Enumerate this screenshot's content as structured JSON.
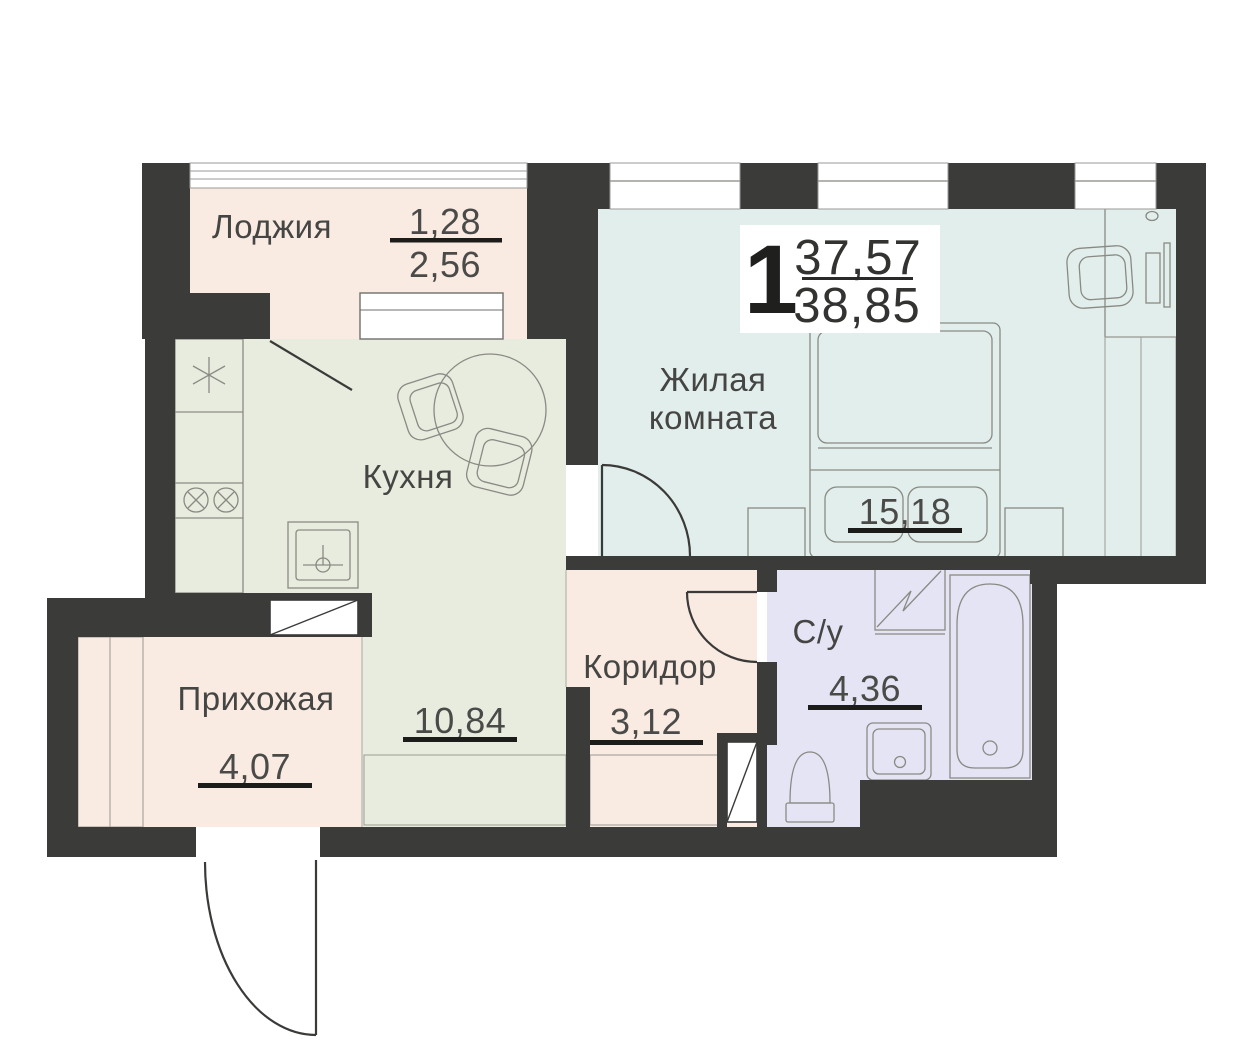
{
  "colors": {
    "wall": "#3b3b39",
    "loggia": "#f9eae2",
    "kitchen": "#e8ecdf",
    "living": "#e2eeec",
    "corridor": "#f9eae2",
    "hallway": "#f9eae2",
    "bathroom": "#e4e4f4"
  },
  "summary": {
    "rooms_count": "1",
    "living_area": "37,57",
    "total_area": "38,85"
  },
  "rooms": {
    "loggia": {
      "label": "Лоджия",
      "area_reduced": "1,28",
      "area_full": "2,56"
    },
    "kitchen": {
      "label": "Кухня",
      "area": "10,84"
    },
    "living": {
      "label_line1": "Жилая",
      "label_line2": "комната",
      "area": "15,18"
    },
    "corridor": {
      "label": "Коридор",
      "area": "3,12"
    },
    "hallway": {
      "label": "Прихожая",
      "area": "4,07"
    },
    "bathroom": {
      "label": "С/у",
      "area": "4,36"
    }
  }
}
